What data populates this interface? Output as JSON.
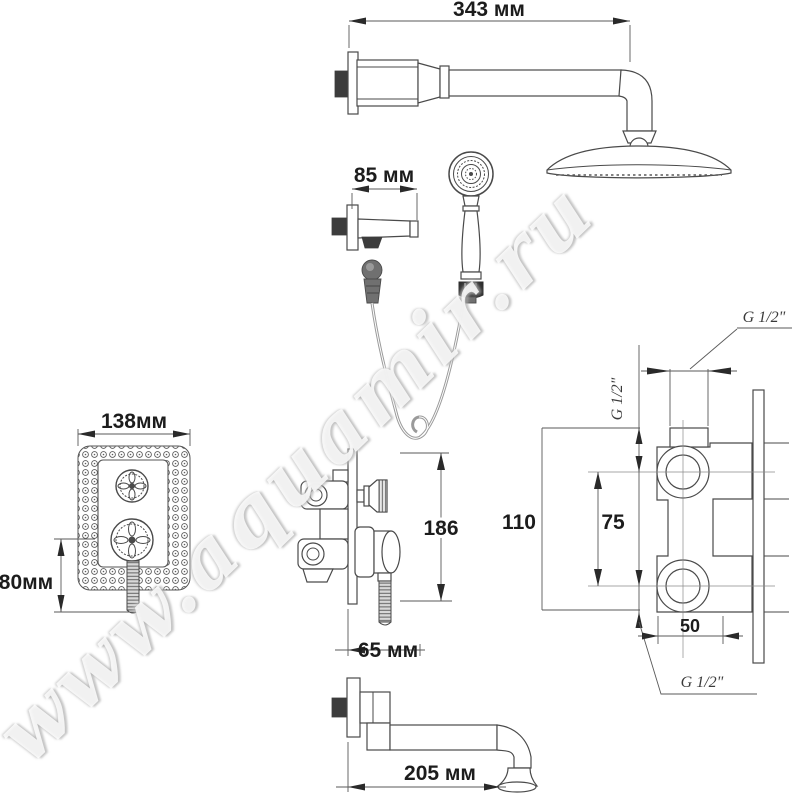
{
  "watermark": {
    "text": "www.aquamir.ru"
  },
  "dimensions": {
    "shower_arm_length": "343 мм",
    "wall_holder_length": "85 мм",
    "faceplate_width": "138мм",
    "faceplate_height": "80мм",
    "valve_height": "186",
    "valve_depth": "65 мм",
    "spout_length": "205 мм",
    "body_total_height": "110",
    "inlet_spacing": "75",
    "inlet_offset": "50"
  },
  "thread_labels": {
    "top": "G 1/2\"",
    "side": "G 1/2\"",
    "bottom": "G 1/2\""
  },
  "colors": {
    "background": "#ffffff",
    "line": "#4a4a4a",
    "dimension_text": "#1c1c1c",
    "watermark_halo": "#b5b5b5"
  }
}
